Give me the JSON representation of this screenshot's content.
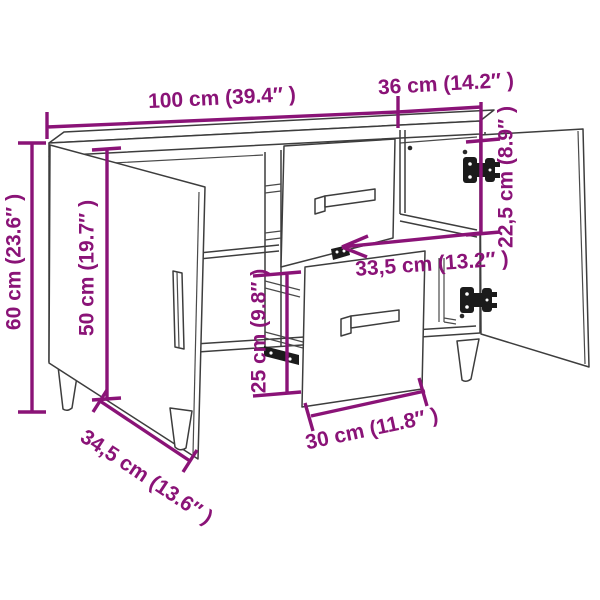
{
  "diagram": {
    "type": "furniture-dimension-diagram",
    "subject": "sideboard with two open doors, two pulled-out drawers, hinges and tapered legs",
    "background": "#ffffff",
    "colors": {
      "dimension_annotations": "#8a1377",
      "line_art": "#3d3d3d",
      "hardware": "#1b1b1b"
    },
    "dims": {
      "overall_width": {
        "label": "100 cm (39.4″ )"
      },
      "depth": {
        "label": "36 cm (14.2″ )"
      },
      "overall_height": {
        "label": "60 cm (23.6″ )"
      },
      "door_height": {
        "label": "50 cm (19.7″ )"
      },
      "upper_compartment_height": {
        "label": "22,5 cm (8.9″ )"
      },
      "inner_width": {
        "label": "33,5 cm (13.2″ )"
      },
      "drawer_height": {
        "label": "25 cm (9.8″ )"
      },
      "drawer_width": {
        "label": "30 cm (11.8″ )"
      },
      "base_width": {
        "label": "34,5 cm (13.6″ )"
      }
    }
  }
}
